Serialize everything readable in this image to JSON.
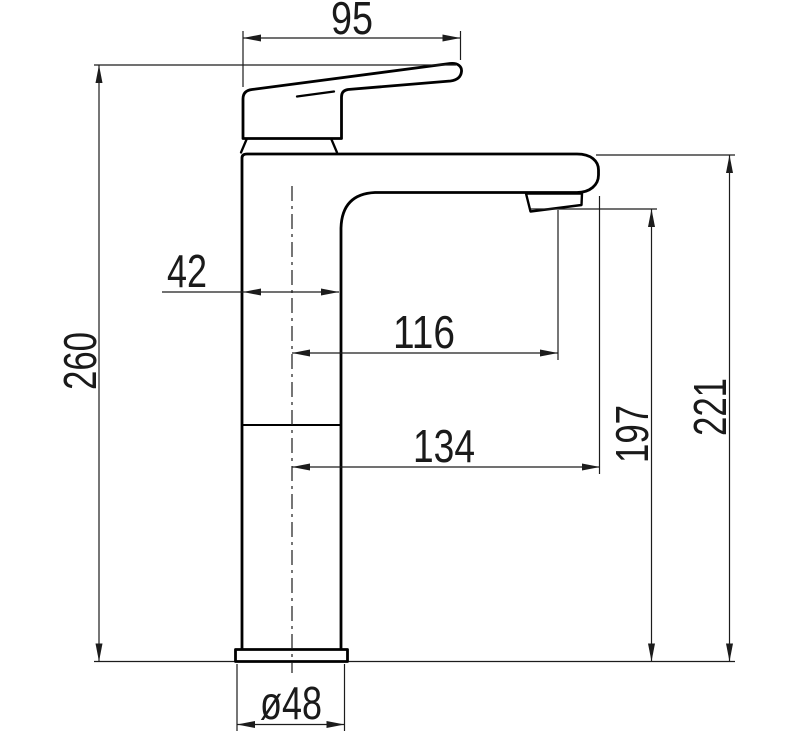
{
  "page": {
    "background": "#ffffff"
  },
  "drawing": {
    "outline_color": "#000000",
    "dimension_line_color": "#1c1c1c",
    "dimensions": {
      "handle_length": "95",
      "overall_height": "260",
      "body_setback": "42",
      "aerator_reach": "116",
      "spout_reach": "134",
      "aerator_height": "197",
      "spout_top_height": "221",
      "base_diameter": "ø48"
    }
  }
}
